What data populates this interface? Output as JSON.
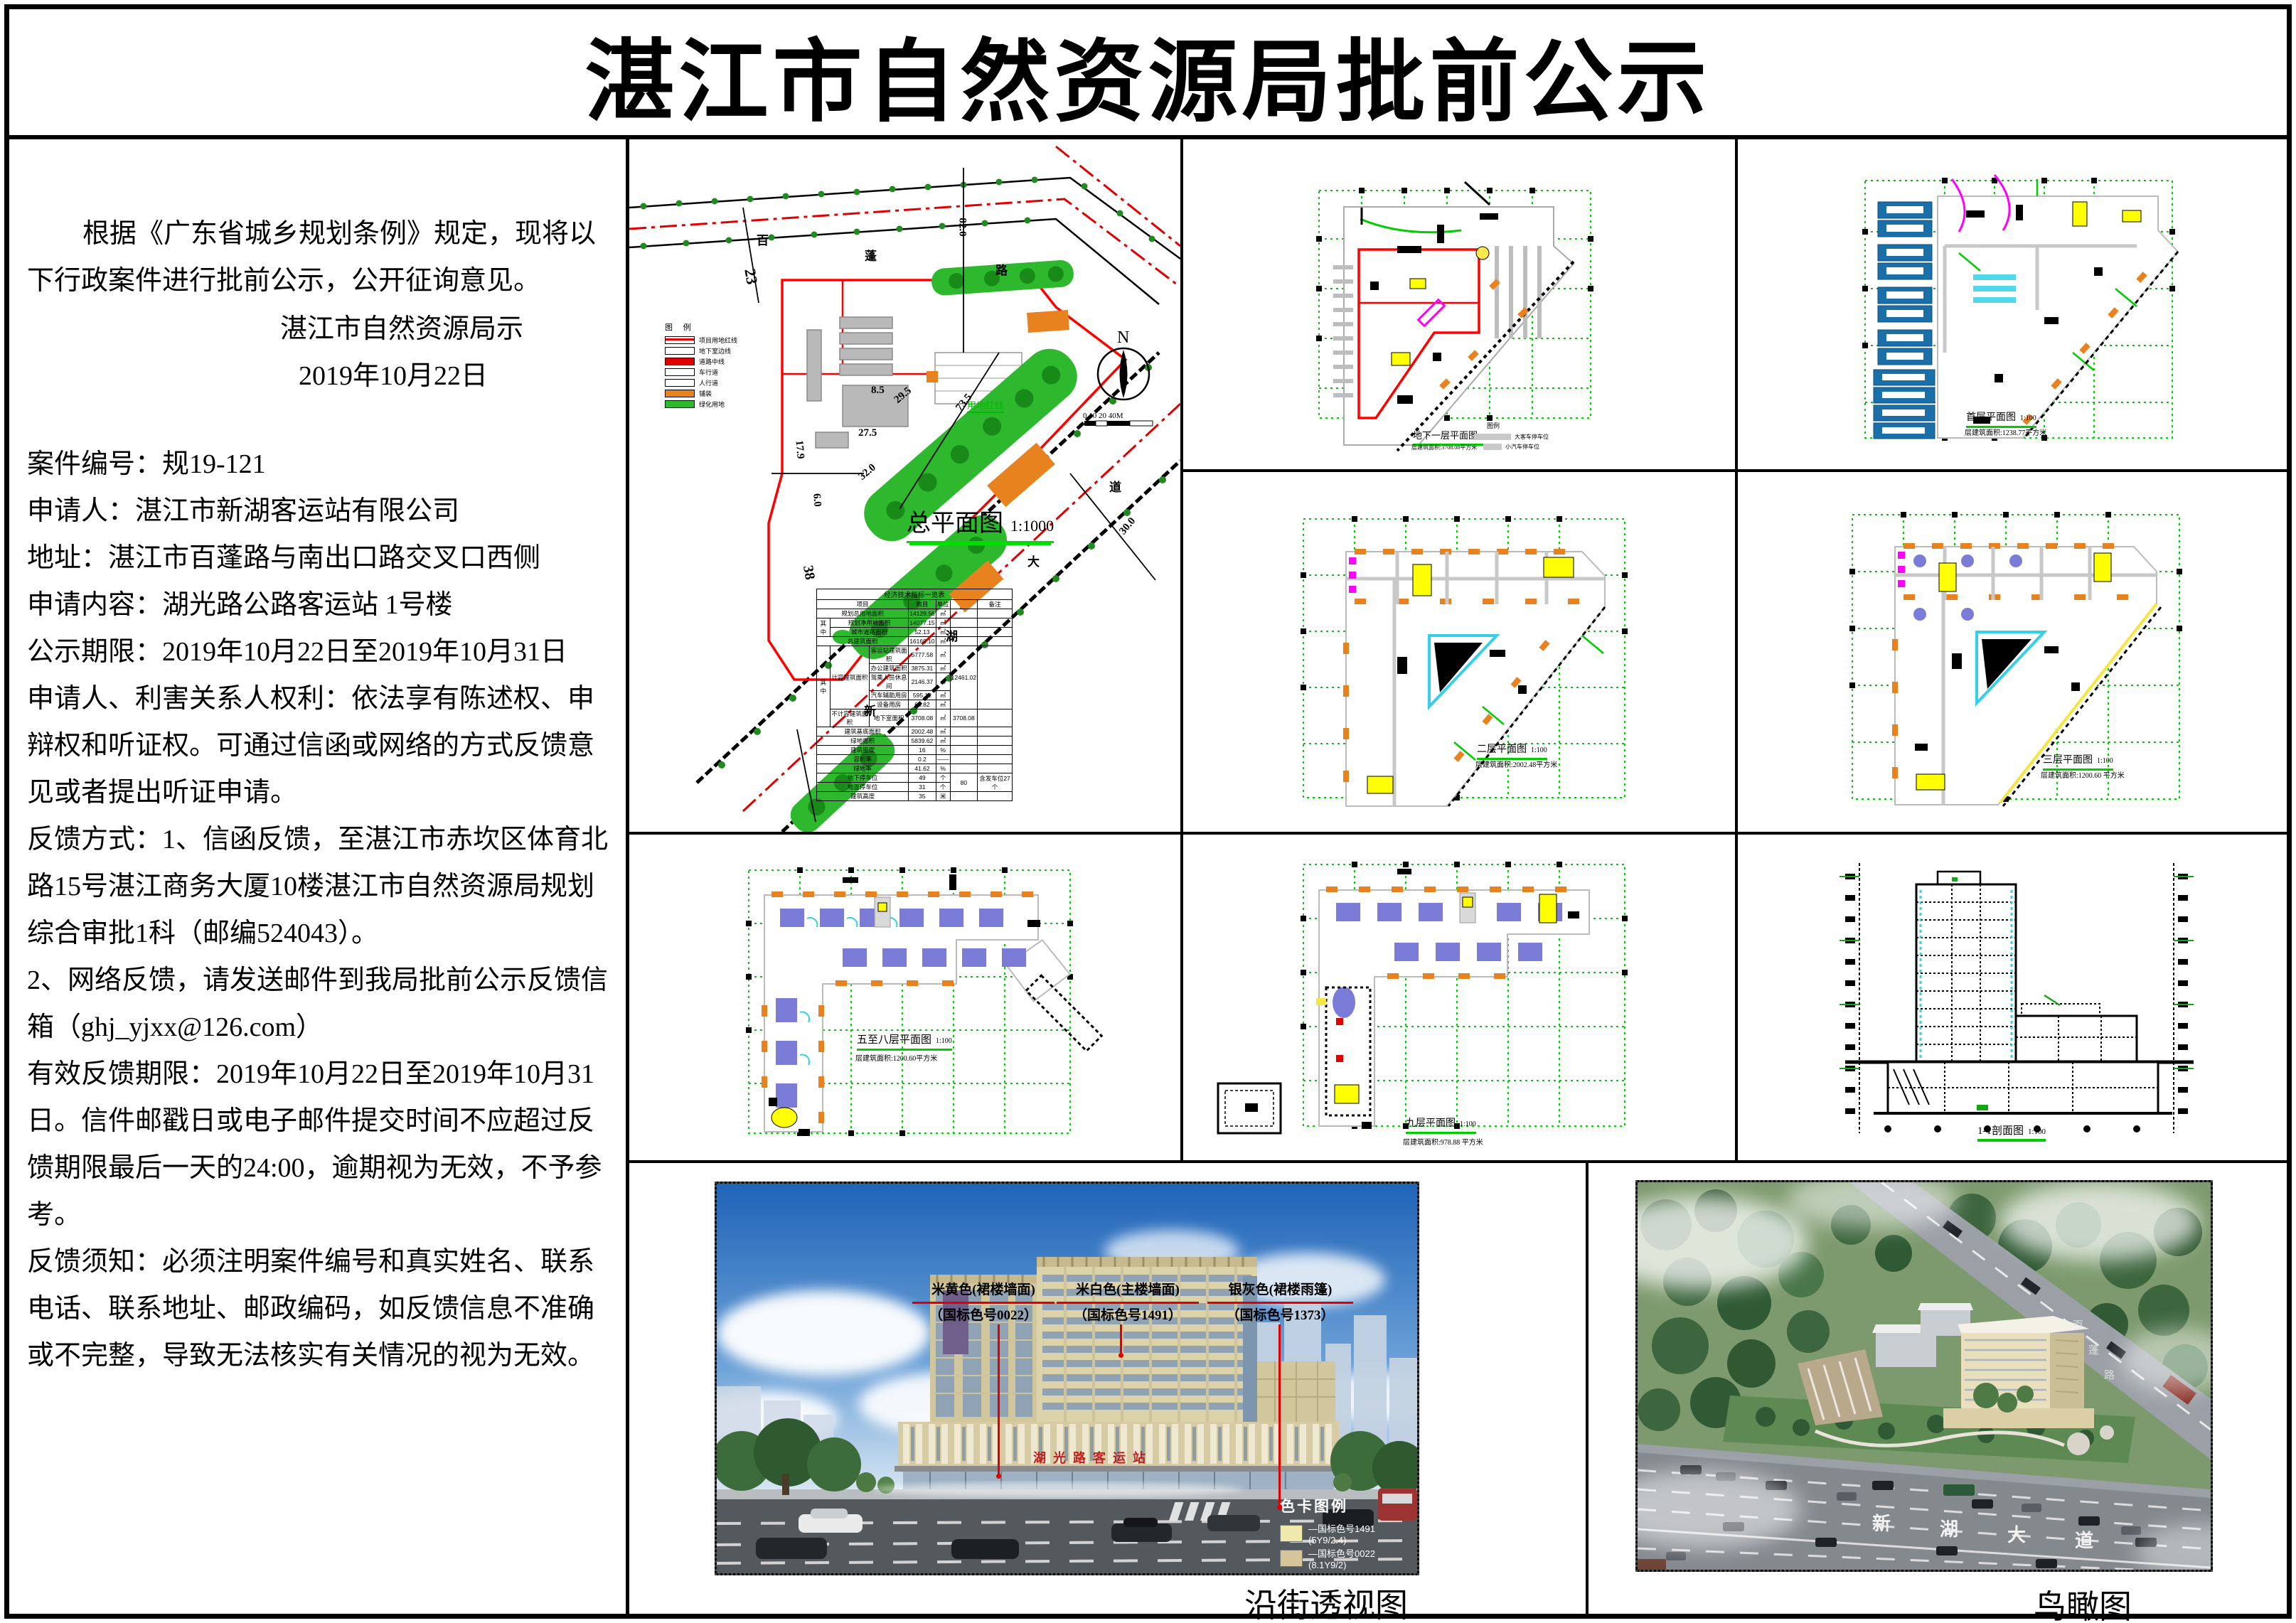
{
  "title": "湛江市自然资源局批前公示",
  "notice": {
    "intro": "根据《广东省城乡规划条例》规定，现将以下行政案件进行批前公示，公开征询意见。",
    "issuer": "湛江市自然资源局示",
    "date": "2019年10月22日",
    "items": [
      "案件编号：规19-121",
      "申请人：湛江市新湖客运站有限公司",
      "地址：湛江市百蓬路与南出口路交叉口西侧",
      "申请内容：湖光路公路客运站 1号楼",
      "公示期限：2019年10月22日至2019年10月31日",
      "申请人、利害关系人权利：依法享有陈述权、申辩权和听证权。可通过信函或网络的方式反馈意见或者提出听证申请。",
      "反馈方式：1、信函反馈，至湛江市赤坎区体育北路15号湛江商务大厦10楼湛江市自然资源局规划综合审批1科（邮编524043）。",
      "2、网络反馈，请发送邮件到我局批前公示反馈信箱（ghj_yjxx@126.com）",
      "有效反馈期限：2019年10月22日至2019年10月31日。信件邮戳日或电子邮件提交时间不应超过反馈期限最后一天的24:00，逾期视为无效，不予参考。",
      "反馈须知：必须注明案件编号和真实姓名、联系电话、联系地址、邮政编码，如反馈信息不准确或不完整，导致无法核实有关情况的视为无效。"
    ]
  },
  "site_plan": {
    "caption": "总平面图",
    "scale": "1:1000",
    "legend_title": "图 例",
    "legend_items": [
      "项目用地红线",
      "地下室边线",
      "道路中线",
      "车行道",
      "人行道",
      "铺装",
      "绿化用地"
    ],
    "north_label": "N",
    "scalebar_label": "0  10  20       40M",
    "red_line_label": "用地红线",
    "road1_chars": [
      "百",
      "蓬",
      "路"
    ],
    "road2_chars": [
      "新",
      "湖",
      "大",
      "道"
    ],
    "dims": [
      "23",
      "82.0",
      "8.5",
      "29.5",
      "73.5",
      "27.5",
      "17.9",
      "6.0",
      "32.0",
      "38",
      "30.0"
    ]
  },
  "indicators": {
    "rows": [
      [
        {
          "t": "经济技术指标一览表",
          "c": 7
        }
      ],
      [
        {
          "t": "项目",
          "c": 3
        },
        {
          "t": "数目"
        },
        {
          "t": "单位"
        },
        {
          "t": ""
        },
        {
          "t": "备注"
        }
      ],
      [
        {
          "t": "规划总用地面积",
          "c": 3
        },
        {
          "t": "14129.56"
        },
        {
          "t": "㎡"
        },
        {
          "t": ""
        },
        {
          "t": ""
        }
      ],
      [
        {
          "t": "其中",
          "r": 2
        },
        {
          "t": "规划净用地面积",
          "c": 2
        },
        {
          "t": "14077.15"
        },
        {
          "t": "㎡"
        },
        {
          "t": ""
        },
        {
          "t": ""
        }
      ],
      [
        {
          "t": "城市道路面积",
          "c": 2
        },
        {
          "t": "52.13"
        },
        {
          "t": "㎡"
        },
        {
          "t": ""
        },
        {
          "t": ""
        }
      ],
      [
        {
          "t": "总建筑面积",
          "c": 3
        },
        {
          "t": "16169.10"
        },
        {
          "t": "㎡"
        },
        {
          "t": ""
        },
        {
          "t": ""
        }
      ],
      [
        {
          "t": "其中",
          "r": 6
        },
        {
          "t": "计容建筑面积",
          "r": 5
        },
        {
          "t": "客运站建筑面积"
        },
        {
          "t": "5777.58"
        },
        {
          "t": "㎡"
        },
        {
          "t": "12461.02",
          "r": 5
        },
        {
          "t": "",
          "r": 5
        }
      ],
      [
        {
          "t": "办公建筑面积"
        },
        {
          "t": "3875.31"
        },
        {
          "t": "㎡"
        }
      ],
      [
        {
          "t": "驾乘人员休息间"
        },
        {
          "t": "2146.37"
        },
        {
          "t": "㎡"
        }
      ],
      [
        {
          "t": "汽车辅助用房"
        },
        {
          "t": "595.12"
        },
        {
          "t": "㎡"
        }
      ],
      [
        {
          "t": "设备用房"
        },
        {
          "t": "66.82"
        },
        {
          "t": "㎡"
        }
      ],
      [
        {
          "t": "不计容建筑面积"
        },
        {
          "t": "地下室面积"
        },
        {
          "t": "3708.08"
        },
        {
          "t": "㎡"
        },
        {
          "t": "3708.08"
        },
        {
          "t": ""
        }
      ],
      [
        {
          "t": "建筑基底面积",
          "c": 3
        },
        {
          "t": "2002.48"
        },
        {
          "t": "㎡"
        },
        {
          "t": ""
        },
        {
          "t": ""
        }
      ],
      [
        {
          "t": "绿地面积",
          "c": 3
        },
        {
          "t": "5839.62"
        },
        {
          "t": "㎡"
        },
        {
          "t": ""
        },
        {
          "t": ""
        }
      ],
      [
        {
          "t": "建筑密度",
          "c": 3
        },
        {
          "t": "16"
        },
        {
          "t": "%"
        },
        {
          "t": ""
        },
        {
          "t": ""
        }
      ],
      [
        {
          "t": "容积率",
          "c": 3
        },
        {
          "t": "0.2"
        },
        {
          "t": "——"
        },
        {
          "t": ""
        },
        {
          "t": ""
        }
      ],
      [
        {
          "t": "绿地率",
          "c": 3
        },
        {
          "t": "41.62"
        },
        {
          "t": "%"
        },
        {
          "t": ""
        },
        {
          "t": ""
        }
      ],
      [
        {
          "t": "地下停车位",
          "c": 3
        },
        {
          "t": "49"
        },
        {
          "t": "个"
        },
        {
          "t": "80",
          "r": 2
        },
        {
          "t": "含发车位27个",
          "r": 2
        }
      ],
      [
        {
          "t": "地面停车位",
          "c": 3
        },
        {
          "t": "31"
        },
        {
          "t": "个"
        }
      ],
      [
        {
          "t": "建筑高度",
          "c": 3
        },
        {
          "t": "35"
        },
        {
          "t": "米"
        },
        {
          "t": ""
        },
        {
          "t": ""
        }
      ]
    ]
  },
  "panels": [
    {
      "caption": "地下一层平面图",
      "scale": "1:100",
      "area": "层建筑面积:3708.08平方米",
      "legend_title": "图例",
      "legend_items": [
        "大客车停车位",
        "小汽车停车位"
      ]
    },
    {
      "caption": "首层平面图",
      "scale": "1:100",
      "area": "层建筑面积:1238.77平方米"
    },
    {
      "caption": "二层平面图",
      "scale": "1:100",
      "area": "层建筑面积:2002.48平方米"
    },
    {
      "caption": "三层平面图",
      "scale": "1:100",
      "area": "层建筑面积:1200.60 平方米"
    },
    {
      "caption": "五至八层平面图",
      "scale": "1:100",
      "area": "层建筑面积:1200.60平方米"
    },
    {
      "caption": "九层平面图",
      "scale": "1:100",
      "area": "层建筑面积:978.88 平方米"
    },
    {
      "caption": "1-1剖面图",
      "scale": "1:100",
      "area": ""
    }
  ],
  "perspective": {
    "caption": "沿街透视图",
    "building_sign": "湖光路客运站",
    "callouts": [
      {
        "name": "米黄色(裙楼墙面)",
        "code": "（国标色号0022）"
      },
      {
        "name": "米白色(主楼墙面)",
        "code": "（国标色号1491）"
      },
      {
        "name": "银灰色(裙楼雨篷)",
        "code": "（国标色号1373）"
      }
    ],
    "color_legend_title": "色卡图例",
    "color_legend": [
      {
        "label": "—国标色号1491 (5Y9/2.4)",
        "color": "#efe9ad"
      },
      {
        "label": "—国标色号0022 (8.1Y9/2)",
        "color": "#d6c49a"
      },
      {
        "label": "—国标色号1373 (2.5PB7.5/1)",
        "color": "#9e9e9e"
      }
    ]
  },
  "birdseye": {
    "caption": "鸟瞰图",
    "road_chars": [
      "新",
      "湖",
      "大",
      "道"
    ],
    "side_road_chars": [
      "百",
      "蓬",
      "路"
    ]
  }
}
